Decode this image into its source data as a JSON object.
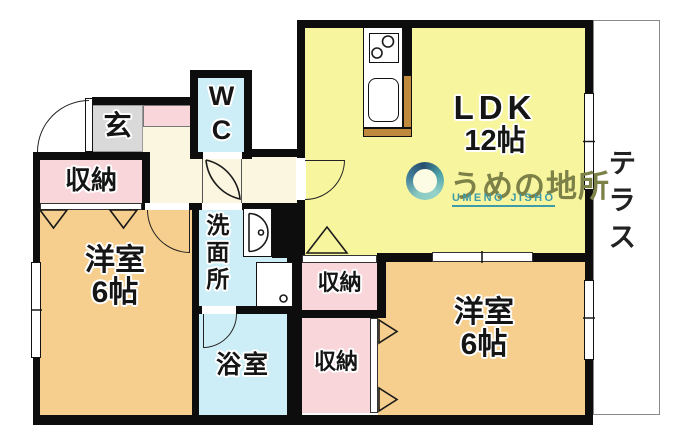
{
  "palette": {
    "wall": "#0d0d0d",
    "ldk_fill": "#F8F59F",
    "bedroom_fill": "#F6CE8D",
    "closet_fill": "#F9D6DA",
    "wet_area_fill": "#CDEEF6",
    "hall_fill": "#FBF6DF",
    "entry_fill": "#D9D9D9",
    "counter_edge": "#C08A3E",
    "terrace_border": "#8a8a8a",
    "watermark_olive": "#7c8148",
    "watermark_teal": "#3e9baa"
  },
  "rooms": {
    "ldk": {
      "name": "LDK",
      "size": "12帖"
    },
    "bedroom_left": {
      "name": "洋室",
      "size": "6帖"
    },
    "bedroom_right": {
      "name": "洋室",
      "size": "6帖"
    },
    "wc": {
      "letters": [
        "W",
        "C"
      ]
    },
    "washroom": {
      "name": "洗面所"
    },
    "bathroom": {
      "name": "浴室"
    },
    "entrance": {
      "name": "玄"
    },
    "terrace": {
      "name": "テラス"
    },
    "closet_left": {
      "name": "収納"
    },
    "closet_mid_top": {
      "name": "収納"
    },
    "closet_mid_bottom": {
      "name": "収納"
    }
  },
  "watermark": {
    "brand": "うめの地所",
    "romaji": "UMENO JISHO"
  }
}
